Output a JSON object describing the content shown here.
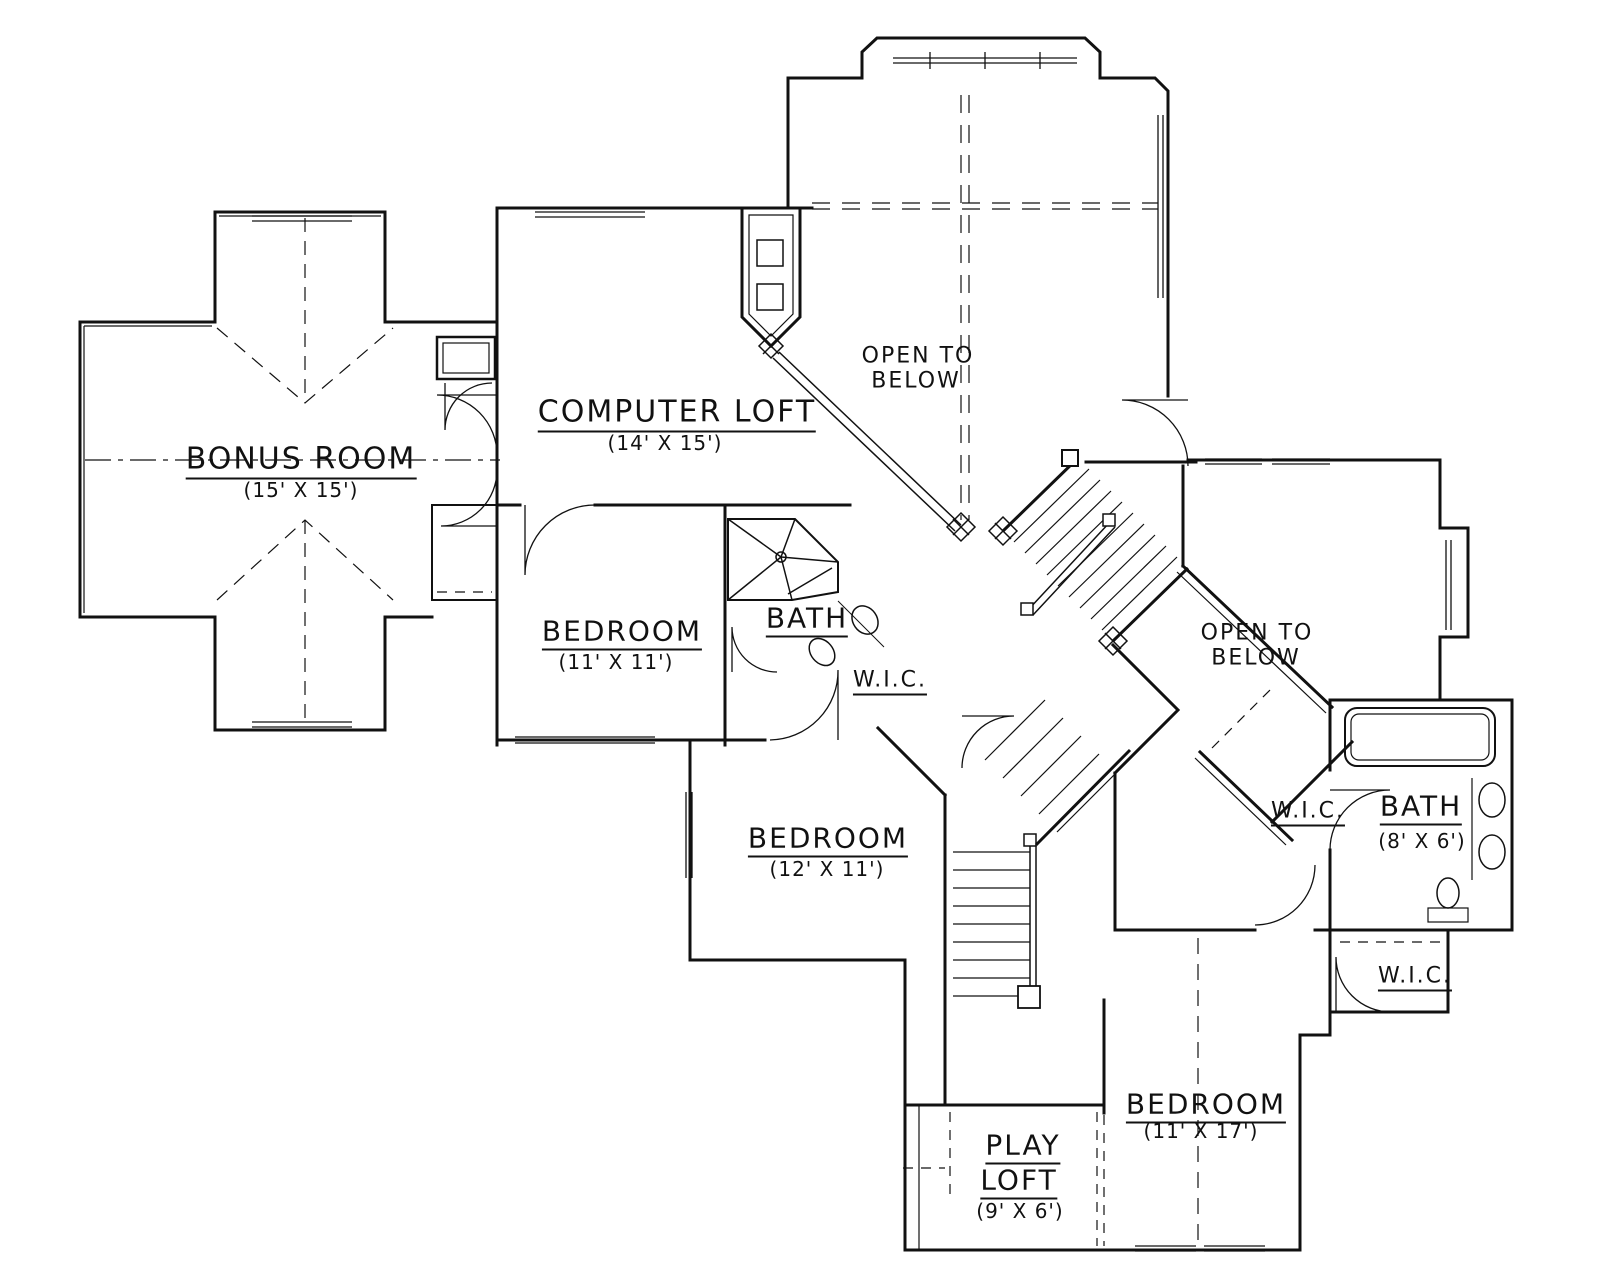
{
  "drawing": {
    "type": "floor plan",
    "background": "#ffffff",
    "line_color": "#111111"
  },
  "rooms": {
    "bonus_room": {
      "name": "BONUS ROOM",
      "dims": "(15' X 15')"
    },
    "computer_loft": {
      "name": "COMPUTER LOFT",
      "dims": "(14' X 15')"
    },
    "open_below_top": {
      "line1": "OPEN TO",
      "line2": "BELOW"
    },
    "bedroom_11x11": {
      "name": "BEDROOM",
      "dims": "(11' X 11')"
    },
    "bath_upper": {
      "name": "BATH"
    },
    "wic_upper": {
      "name": "W.I.C."
    },
    "bedroom_12x11": {
      "name": "BEDROOM",
      "dims": "(12' X 11')"
    },
    "open_below_right": {
      "line1": "OPEN TO",
      "line2": "BELOW"
    },
    "wic_right": {
      "name": "W.I.C."
    },
    "bath_right": {
      "name": "BATH",
      "dims": "(8' X 6')"
    },
    "wic_lower": {
      "name": "W.I.C."
    },
    "bedroom_11x17": {
      "name": "BEDROOM",
      "dims": "(11' X 17')"
    },
    "play_loft": {
      "line1": "PLAY",
      "line2": "LOFT",
      "dims": "(9' X 6')"
    }
  }
}
